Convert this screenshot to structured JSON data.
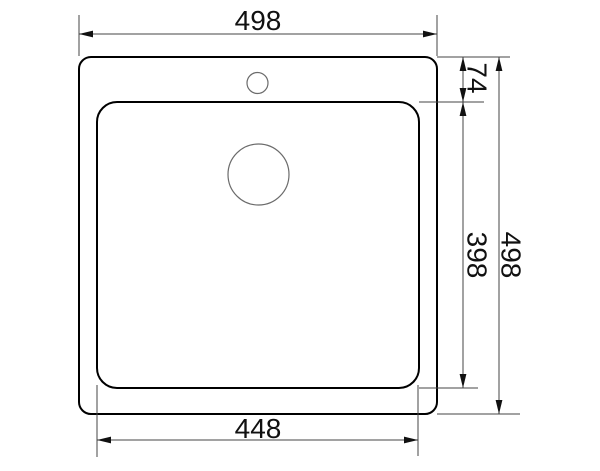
{
  "drawing": {
    "name": "sink-top-view-technical-drawing",
    "canvas": {
      "width": 600,
      "height": 471
    },
    "colors": {
      "background": "#ffffff",
      "outline": "#000000",
      "hole_stroke": "#6b6b6b",
      "dimension_line": "#444444",
      "arrow_fill": "#111111",
      "text": "#111111"
    },
    "outer_body": {
      "x": 79,
      "y": 57,
      "width": 358,
      "height": 357,
      "corner_radius": 12,
      "stroke_width": 2
    },
    "basin": {
      "x": 97,
      "y": 102,
      "width": 322,
      "height": 286,
      "corner_radius": 20,
      "stroke_width": 2
    },
    "faucet_hole": {
      "cx": 257.5,
      "cy": 83,
      "r": 10.5,
      "stroke_width": 1.2
    },
    "drain_hole": {
      "cx": 258.5,
      "cy": 174.5,
      "r": 30.5,
      "stroke_width": 1.2
    },
    "arrow": {
      "length": 14,
      "half_width": 3.4
    },
    "dimensions": [
      {
        "id": "overall-width",
        "label": "498",
        "orientation": "horizontal",
        "line": {
          "x1": 79,
          "y1": 34,
          "x2": 437,
          "y2": 34
        },
        "extensions": [
          {
            "x1": 79,
            "y1": 15,
            "x2": 79,
            "y2": 56
          },
          {
            "x1": 437,
            "y1": 15,
            "x2": 437,
            "y2": 56
          }
        ],
        "text": {
          "x": 258,
          "y": 30,
          "rotate": 0
        }
      },
      {
        "id": "faucet-offset",
        "label": "74",
        "orientation": "vertical",
        "line": {
          "x1": 463,
          "y1": 57,
          "x2": 463,
          "y2": 102
        },
        "extensions": [
          {
            "x1": 437,
            "y1": 57,
            "x2": 510,
            "y2": 57
          },
          {
            "x1": 419,
            "y1": 102,
            "x2": 484,
            "y2": 102
          }
        ],
        "text": {
          "x": 477,
          "y": 78,
          "rotate": 90
        }
      },
      {
        "id": "basin-depth",
        "label": "398",
        "orientation": "vertical",
        "line": {
          "x1": 463,
          "y1": 102,
          "x2": 463,
          "y2": 388
        },
        "extensions": [
          {
            "x1": 419,
            "y1": 388,
            "x2": 478,
            "y2": 388
          }
        ],
        "text": {
          "x": 477,
          "y": 255,
          "rotate": 90
        }
      },
      {
        "id": "overall-height",
        "label": "498",
        "orientation": "vertical",
        "line": {
          "x1": 499,
          "y1": 57,
          "x2": 499,
          "y2": 414
        },
        "extensions": [
          {
            "x1": 437,
            "y1": 414,
            "x2": 520,
            "y2": 414
          }
        ],
        "text": {
          "x": 511,
          "y": 255,
          "rotate": 90
        }
      },
      {
        "id": "basin-width",
        "label": "448",
        "orientation": "horizontal",
        "line": {
          "x1": 97,
          "y1": 440,
          "x2": 418,
          "y2": 440
        },
        "extensions": [
          {
            "x1": 97,
            "y1": 385,
            "x2": 97,
            "y2": 457
          },
          {
            "x1": 418,
            "y1": 385,
            "x2": 418,
            "y2": 456
          }
        ],
        "text": {
          "x": 258,
          "y": 438,
          "rotate": 0
        }
      }
    ]
  }
}
